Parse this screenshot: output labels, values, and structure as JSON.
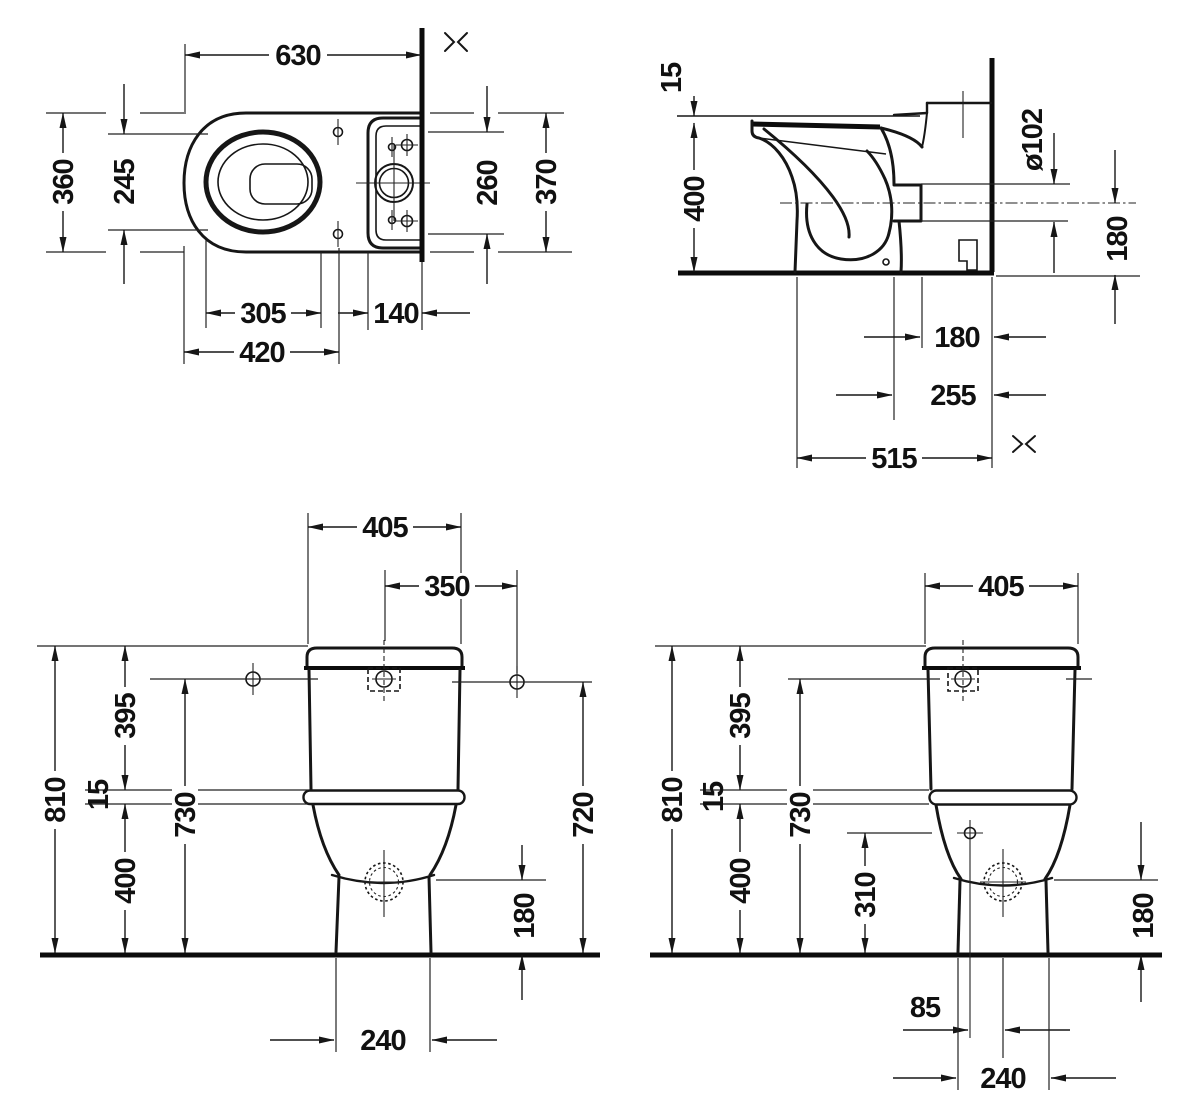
{
  "palette": {
    "line": "#161616",
    "background": "#ffffff"
  },
  "views": {
    "plan": {
      "dims": {
        "overall_length": "630",
        "overall_width": "360",
        "seat_width": "245",
        "tank_inner_width": "260",
        "tank_overall_width": "370",
        "seat_front_to_hinge": "305",
        "tank_to_wall": "140",
        "front_to_hinge": "420"
      }
    },
    "side": {
      "dims": {
        "seat_thickness": "15",
        "bowl_height": "400",
        "outlet_diameter": "ø102",
        "outlet_center_to_floor": "180",
        "outlet_to_wall": "180",
        "trap_center_to_wall": "255",
        "front_to_wall": "515"
      }
    },
    "back": {
      "dims": {
        "tank_width": "405",
        "center_to_hole": "350",
        "overall_height": "810",
        "tank_height": "395",
        "joint_height": "15",
        "bowl_height": "400",
        "left_hole_height": "730",
        "right_hole_height": "720",
        "outlet_height": "180",
        "base_width": "240"
      }
    },
    "front": {
      "dims": {
        "tank_width": "405",
        "overall_height": "810",
        "tank_height": "395",
        "joint_height": "15",
        "bowl_height": "400",
        "hole_height": "730",
        "side_hole_height": "310",
        "outlet_height": "180",
        "outlet_offset": "85",
        "base_width": "240"
      }
    }
  }
}
